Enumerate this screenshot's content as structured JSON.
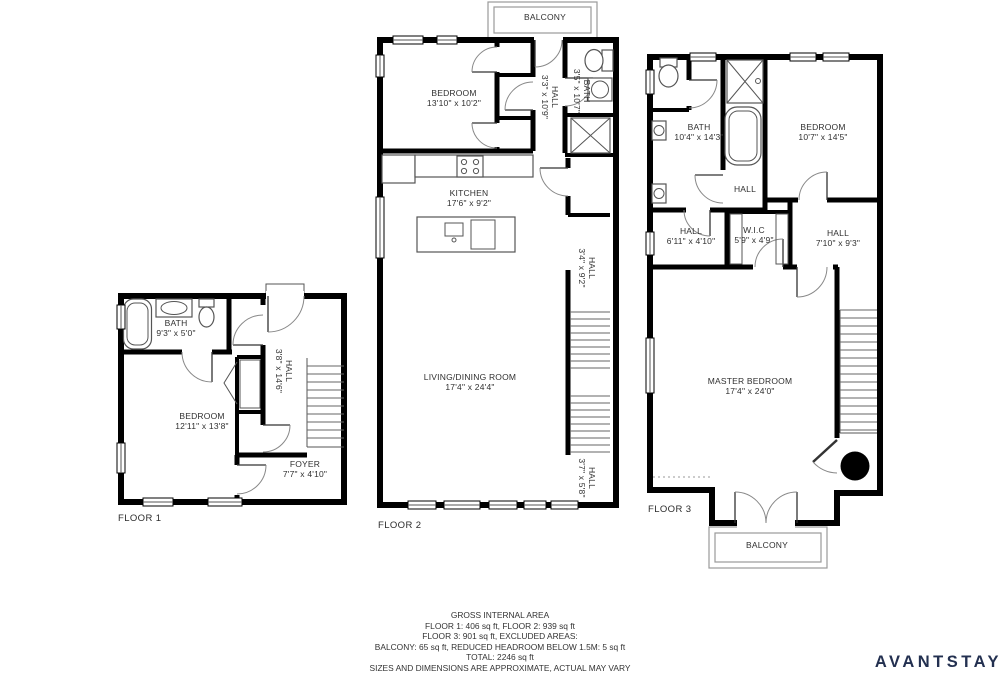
{
  "colors": {
    "wall": "#000000",
    "no_entry_red": "#d32028",
    "brand_navy": "#233050"
  },
  "icons": {
    "no_entry": "prohibition-circle-with-slash"
  },
  "floor1": {
    "label": "FLOOR 1",
    "bath": {
      "name": "BATH",
      "dims": "9'3\" x 5'0\""
    },
    "bedroom": {
      "name": "BEDROOM",
      "dims": "12'11\" x 13'8\""
    },
    "hall": {
      "name": "HALL",
      "dims": "3'8\" x 14'6\""
    },
    "foyer": {
      "name": "FOYER",
      "dims": "7'7\" x 4'10\""
    }
  },
  "floor2": {
    "label": "FLOOR 2",
    "balcony": {
      "name": "BALCONY"
    },
    "bedroom": {
      "name": "BEDROOM",
      "dims": "13'10\" x 10'2\""
    },
    "hall_upper": {
      "name": "HALL",
      "dims": "3'3\" x 10'9\""
    },
    "bath": {
      "name": "BATH",
      "dims": "3'5\" x 10'7\""
    },
    "kitchen": {
      "name": "KITCHEN",
      "dims": "17'6\" x 9'2\""
    },
    "hall_mid": {
      "name": "HALL",
      "dims": "3'4\" x 9'2\""
    },
    "living": {
      "name": "LIVING/DINING ROOM",
      "dims": "17'4\" x 24'4\""
    },
    "hall_lower": {
      "name": "HALL",
      "dims": "3'7\" x 5'8\""
    }
  },
  "floor3": {
    "label": "FLOOR 3",
    "bath": {
      "name": "BATH",
      "dims": "10'4\" x 14'3\""
    },
    "bedroom": {
      "name": "BEDROOM",
      "dims": "10'7\" x 14'5\""
    },
    "hall_center": {
      "name": "HALL"
    },
    "hall_left": {
      "name": "HALL",
      "dims": "6'11\" x 4'10\""
    },
    "wic": {
      "name": "W.I.C",
      "dims": "5'9\" x 4'9\""
    },
    "hall_right": {
      "name": "HALL",
      "dims": "7'10\" x 9'3\""
    },
    "master": {
      "name": "MASTER BEDROOM",
      "dims": "17'4\" x 24'0\""
    },
    "balcony": {
      "name": "BALCONY"
    }
  },
  "summary": {
    "lines": [
      "GROSS INTERNAL AREA",
      "FLOOR 1: 406 sq ft, FLOOR 2: 939 sq ft",
      "FLOOR 3: 901 sq ft, EXCLUDED AREAS:",
      "BALCONY: 65 sq ft, REDUCED HEADROOM BELOW 1.5M: 5 sq ft",
      "TOTAL: 2246 sq ft",
      "SIZES AND DIMENSIONS ARE APPROXIMATE, ACTUAL MAY VARY"
    ]
  },
  "brand": {
    "logo_text": "AVANTSTAY"
  }
}
